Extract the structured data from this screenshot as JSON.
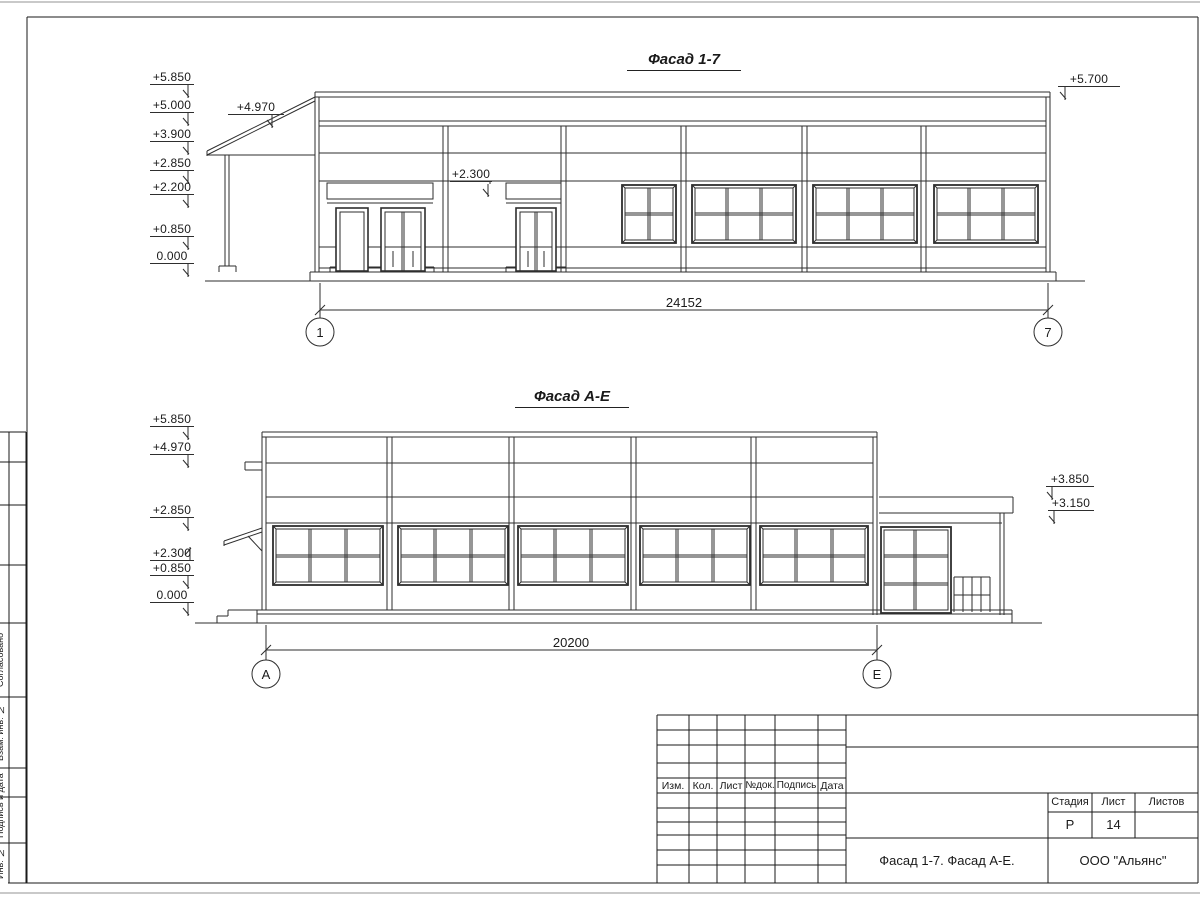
{
  "sheet": {
    "facade_top": {
      "title": "Фасад 1-7",
      "dimension": "24152",
      "grid_left": "1",
      "grid_right": "7",
      "elevations_left": [
        "+5.850",
        "+5.000",
        "+3.900",
        "+2.850",
        "+2.200",
        "+0.850",
        "0.000"
      ],
      "elevation_canopy": "+4.970",
      "elevation_mid": "+2.300",
      "elevation_right": "+5.700"
    },
    "facade_bottom": {
      "title": "Фасад А-Е",
      "dimension": "20200",
      "grid_left": "А",
      "grid_right": "Е",
      "elevations_left": [
        "+5.850",
        "+4.970",
        "+2.850",
        "+2.300",
        "+0.850",
        "0.000"
      ],
      "elevations_right": [
        "+3.850",
        "+3.150"
      ]
    },
    "title_block": {
      "columns": [
        "Изм.",
        "Кол.",
        "Лист",
        "№док.",
        "Подпись",
        "Дата"
      ],
      "stage_label": "Стадия",
      "sheet_label": "Лист",
      "sheets_label": "Листов",
      "stage_value": "Р",
      "sheet_value": "14",
      "sheets_value": "",
      "drawing_name": "Фасад 1-7. Фасад А-Е.",
      "organization": "ООО \"Альянс\""
    },
    "side_stamp": {
      "labels": [
        "Согласовано",
        "Взам. инв. №",
        "Подпись и дата",
        "Инв. № подл."
      ]
    },
    "line_color": "#2e2e2e",
    "frame_color": "#1a1a1a"
  }
}
